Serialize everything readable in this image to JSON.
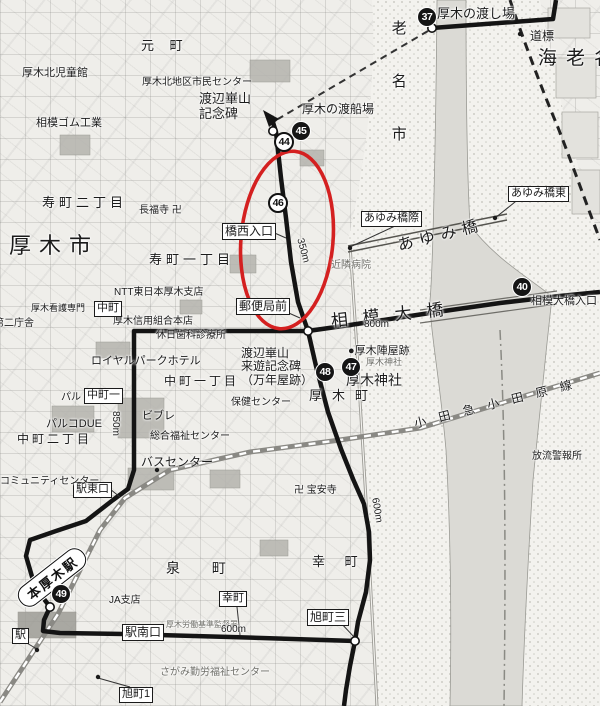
{
  "colors": {
    "route": "#141414",
    "annotation_ellipse": "#d42020",
    "water": "#d9d8d3",
    "boundary": "#222222"
  },
  "station": {
    "name": "本厚木駅"
  },
  "labels": [
    {
      "id": "atsugi-watashiba",
      "t": "厚木の渡し場",
      "x": 437,
      "y": 7,
      "s": 13
    },
    {
      "id": "dohyo",
      "t": "道標",
      "x": 530,
      "y": 30,
      "s": 12
    },
    {
      "id": "ebina-city-big",
      "t": "海老名",
      "x": 538,
      "y": 48,
      "s": 19,
      "ls": 9
    },
    {
      "id": "ebina-shi-vertical",
      "t": "老名市",
      "x": 389,
      "y": 20,
      "s": 15,
      "vert": 1,
      "ls": 38
    },
    {
      "id": "kazan-kinenhi",
      "t": "渡辺崋山\n記念碑",
      "x": 199,
      "y": 92,
      "s": 13
    },
    {
      "id": "tosenba",
      "t": "厚木の渡船場",
      "x": 302,
      "y": 103,
      "s": 12
    },
    {
      "id": "hashinishi-iriguchi",
      "t": "橋西入口",
      "x": 222,
      "y": 223,
      "s": 12,
      "box": 1
    },
    {
      "id": "yubinkyoku-mae",
      "t": "郵便局前",
      "x": 236,
      "y": 298,
      "s": 12,
      "box": 1
    },
    {
      "id": "ayumibashi-giwa",
      "t": "あゆみ橋際",
      "x": 361,
      "y": 211,
      "s": 11,
      "box": 1
    },
    {
      "id": "ayumibashi-higashi",
      "t": "あゆみ橋東",
      "x": 508,
      "y": 186,
      "s": 11,
      "box": 1
    },
    {
      "id": "ayumibashi-big",
      "t": "あゆみ橋",
      "x": 396,
      "y": 238,
      "s": 16,
      "ls": 6,
      "rot": -14
    },
    {
      "id": "kinrin-byoin",
      "t": "近隣病院",
      "x": 331,
      "y": 260,
      "s": 10,
      "gray": 1
    },
    {
      "id": "sagami-ohashi-iriguchi",
      "t": "相模大橋入口",
      "x": 531,
      "y": 295,
      "s": 11
    },
    {
      "id": "sagami-ohashi-big",
      "t": "相模大橋",
      "x": 330,
      "y": 312,
      "s": 17,
      "ls": 15,
      "rot": -6
    },
    {
      "id": "dist-800m",
      "t": "800m",
      "x": 364,
      "y": 319,
      "s": 10
    },
    {
      "id": "jinya-ato",
      "t": "●厚木陣屋跡",
      "x": 348,
      "y": 345,
      "s": 11
    },
    {
      "id": "jinja-small",
      "t": "厚木神社",
      "x": 366,
      "y": 357,
      "s": 9,
      "gray": 1
    },
    {
      "id": "jinja-big",
      "t": "厚木神社",
      "x": 346,
      "y": 373,
      "s": 14
    },
    {
      "id": "kazan-raiyu-kinenhi",
      "t": "渡辺崋山\n来遊記念碑\n（万年屋跡）",
      "x": 241,
      "y": 347,
      "s": 12
    },
    {
      "id": "atsugi-machi",
      "t": "厚木町",
      "x": 309,
      "y": 389,
      "s": 13,
      "ls": 10
    },
    {
      "id": "hoken-center",
      "t": "保健センター",
      "x": 231,
      "y": 397,
      "s": 10
    },
    {
      "id": "sogo-fukushi-center",
      "t": "総合福祉センター",
      "x": 150,
      "y": 431,
      "s": 10
    },
    {
      "id": "royal-park-hotel",
      "t": "ロイヤルパークホテル",
      "x": 91,
      "y": 355,
      "s": 11
    },
    {
      "id": "nakacho-1chome",
      "t": "中町一丁目",
      "x": 164,
      "y": 375,
      "s": 12,
      "ls": 3
    },
    {
      "id": "nakacho-1",
      "t": "中町一",
      "x": 84,
      "y": 388,
      "s": 11,
      "box": 1
    },
    {
      "id": "pal",
      "t": "パル",
      "x": 61,
      "y": 392,
      "s": 10
    },
    {
      "id": "parco-due",
      "t": "パルコDUE",
      "x": 46,
      "y": 418,
      "s": 11
    },
    {
      "id": "nakacho-2chome",
      "t": "中町二丁目",
      "x": 17,
      "y": 433,
      "s": 12,
      "ls": 3
    },
    {
      "id": "vivre",
      "t": "ビブレ",
      "x": 142,
      "y": 410,
      "s": 11
    },
    {
      "id": "bus-center",
      "t": "バスセンター",
      "x": 141,
      "y": 456,
      "s": 12
    },
    {
      "id": "eki-higashiguchi",
      "t": "駅東口",
      "x": 73,
      "y": 482,
      "s": 11,
      "box": 1
    },
    {
      "id": "dist-850m",
      "t": "850m",
      "x": 121,
      "y": 411,
      "s": 10,
      "rot": 90
    },
    {
      "id": "kyujitsu-shika",
      "t": "休日歯科診療所",
      "x": 156,
      "y": 330,
      "s": 10
    },
    {
      "id": "shinyo-kumiai",
      "t": "厚木信用組合本店",
      "x": 113,
      "y": 316,
      "s": 10
    },
    {
      "id": "nakacho",
      "t": "中町",
      "x": 94,
      "y": 301,
      "s": 11,
      "box": 1
    },
    {
      "id": "ntt-atsugi",
      "t": "NTT東日本厚木支店",
      "x": 114,
      "y": 287,
      "s": 10
    },
    {
      "id": "kango-semmon",
      "t": "厚木看護専門",
      "x": 31,
      "y": 303,
      "s": 9
    },
    {
      "id": "dai2-chosha",
      "t": "第二庁舎",
      "x": -6,
      "y": 318,
      "s": 10
    },
    {
      "id": "kotobuki-2chome",
      "t": "寿町二丁目",
      "x": 42,
      "y": 196,
      "s": 13,
      "ls": 4
    },
    {
      "id": "chofukuji",
      "t": "長福寺 卍",
      "x": 139,
      "y": 205,
      "s": 10
    },
    {
      "id": "atsugi-shi-big",
      "t": "厚木市",
      "x": 9,
      "y": 234,
      "s": 22,
      "ls": 8
    },
    {
      "id": "kotobuki-1chome",
      "t": "寿町一丁目",
      "x": 149,
      "y": 253,
      "s": 13,
      "ls": 4
    },
    {
      "id": "jidokan",
      "t": "厚木北児童館",
      "x": 22,
      "y": 67,
      "s": 11
    },
    {
      "id": "sagami-gomu",
      "t": "相模ゴム工業",
      "x": 36,
      "y": 117,
      "s": 11
    },
    {
      "id": "motomachi",
      "t": "元 町",
      "x": 141,
      "y": 39,
      "s": 13,
      "ls": 6
    },
    {
      "id": "kita-chiku-center",
      "t": "厚木北地区市民センター",
      "x": 142,
      "y": 77,
      "s": 10
    },
    {
      "id": "eki",
      "t": "駅",
      "x": 12,
      "y": 628,
      "s": 11,
      "box": 1
    },
    {
      "id": "ja-shiten",
      "t": "JA支店",
      "x": 109,
      "y": 595,
      "s": 10
    },
    {
      "id": "izumicho",
      "t": "泉 町",
      "x": 166,
      "y": 561,
      "s": 14,
      "ls": 14
    },
    {
      "id": "saiwaicho-box",
      "t": "幸町",
      "x": 219,
      "y": 591,
      "s": 11,
      "box": 1
    },
    {
      "id": "saiwaicho",
      "t": "幸 町",
      "x": 312,
      "y": 555,
      "s": 13,
      "ls": 8
    },
    {
      "id": "eki-minamiguchi",
      "t": "駅南口",
      "x": 122,
      "y": 624,
      "s": 12,
      "box": 1
    },
    {
      "id": "rodo-kantokusho",
      "t": "厚木労働基準監督署",
      "x": 166,
      "y": 621,
      "s": 8,
      "gray": 1
    },
    {
      "id": "dist-600m-south",
      "t": "600m",
      "x": 221,
      "y": 624,
      "s": 10
    },
    {
      "id": "asahicho-3",
      "t": "旭町三",
      "x": 307,
      "y": 609,
      "s": 12,
      "box": 1
    },
    {
      "id": "asahicho-1",
      "t": "旭町1",
      "x": 119,
      "y": 687,
      "s": 11,
      "box": 1
    },
    {
      "id": "kinro-fukushi",
      "t": "さがみ勤労福祉センター",
      "x": 160,
      "y": 667,
      "s": 10,
      "gray": 1
    },
    {
      "id": "hoanji",
      "t": "卍 宝安寺",
      "x": 294,
      "y": 485,
      "s": 10
    },
    {
      "id": "dist-600m-east",
      "t": "600m",
      "x": 380,
      "y": 497,
      "s": 10,
      "rot": 80
    },
    {
      "id": "dist-350m",
      "t": "350m",
      "x": 305,
      "y": 237,
      "s": 10,
      "rot": 75
    },
    {
      "id": "young-community-center",
      "t": "ヤングコミュニティセンター",
      "x": -30,
      "y": 476,
      "s": 10
    },
    {
      "id": "odakyu-odawara-line",
      "t": "小田急小田原線",
      "x": 413,
      "y": 418,
      "s": 12,
      "ls": 13,
      "rot": -14
    },
    {
      "id": "horyu-keihojo",
      "t": "放流警報所",
      "x": 532,
      "y": 451,
      "s": 10
    }
  ],
  "route_markers": [
    {
      "num": "37",
      "x": 427,
      "y": 17,
      "style": "solid"
    },
    {
      "num": "45",
      "x": 301,
      "y": 131,
      "style": "solid"
    },
    {
      "num": "44",
      "x": 284,
      "y": 142,
      "style": "ring"
    },
    {
      "num": "46",
      "x": 278,
      "y": 203,
      "style": "ring"
    },
    {
      "num": "40",
      "x": 522,
      "y": 287,
      "style": "solid"
    },
    {
      "num": "47",
      "x": 351,
      "y": 367,
      "style": "solid"
    },
    {
      "num": "48",
      "x": 325,
      "y": 372,
      "style": "solid"
    },
    {
      "num": "49",
      "x": 61,
      "y": 594,
      "style": "solid"
    }
  ]
}
